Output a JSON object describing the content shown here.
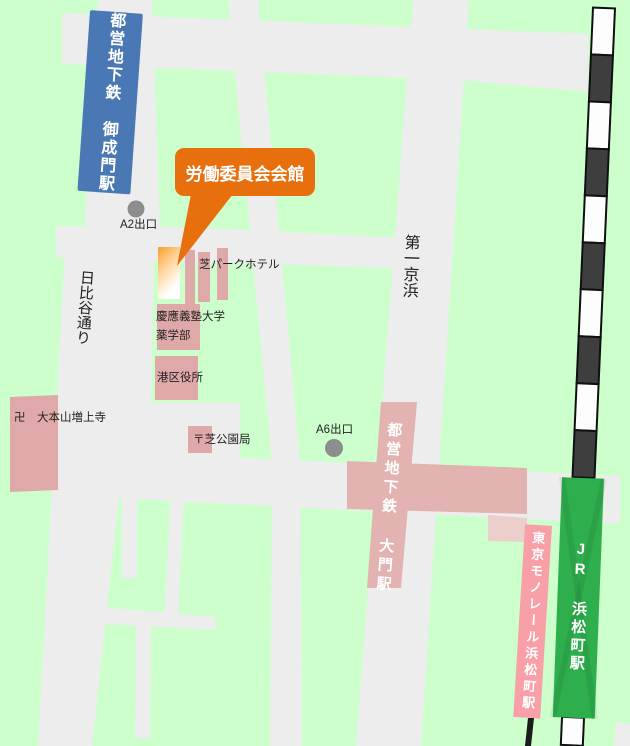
{
  "colors": {
    "background": "#ccffcc",
    "road": "#ededed",
    "building_pink": "#e0a9a9",
    "station_area_pink": "#e2b3b0",
    "station_pale_pink": "#eccfcd",
    "monorail_pink": "#f99fa7",
    "jr_green": "#2fae4e",
    "subway_blue": "#4a78b5",
    "callout_orange": "#e76f0e",
    "railway_dark": "#3e3e3e",
    "highlight_top": "#f9a02a"
  },
  "callout": {
    "text": "労働委員会会館"
  },
  "stations": {
    "onarimon": "都営地下鉄 御成門駅",
    "daimon": "都営地下鉄 大門駅",
    "monorail": "東京モノレール浜松町駅",
    "jr": "JR 浜松町駅"
  },
  "exits": {
    "a2": "A2出口",
    "a6": "A6出口"
  },
  "streets": {
    "hibiya": "日比谷通り",
    "daiichi_keihin": "第一京浜"
  },
  "places": {
    "hotel": "芝パークホテル",
    "keio": "慶應義塾大学",
    "keio_dept": "薬学部",
    "ward_office": "港区役所",
    "post_office": "〒芝公園局",
    "temple": "卍　大本山増上寺"
  }
}
